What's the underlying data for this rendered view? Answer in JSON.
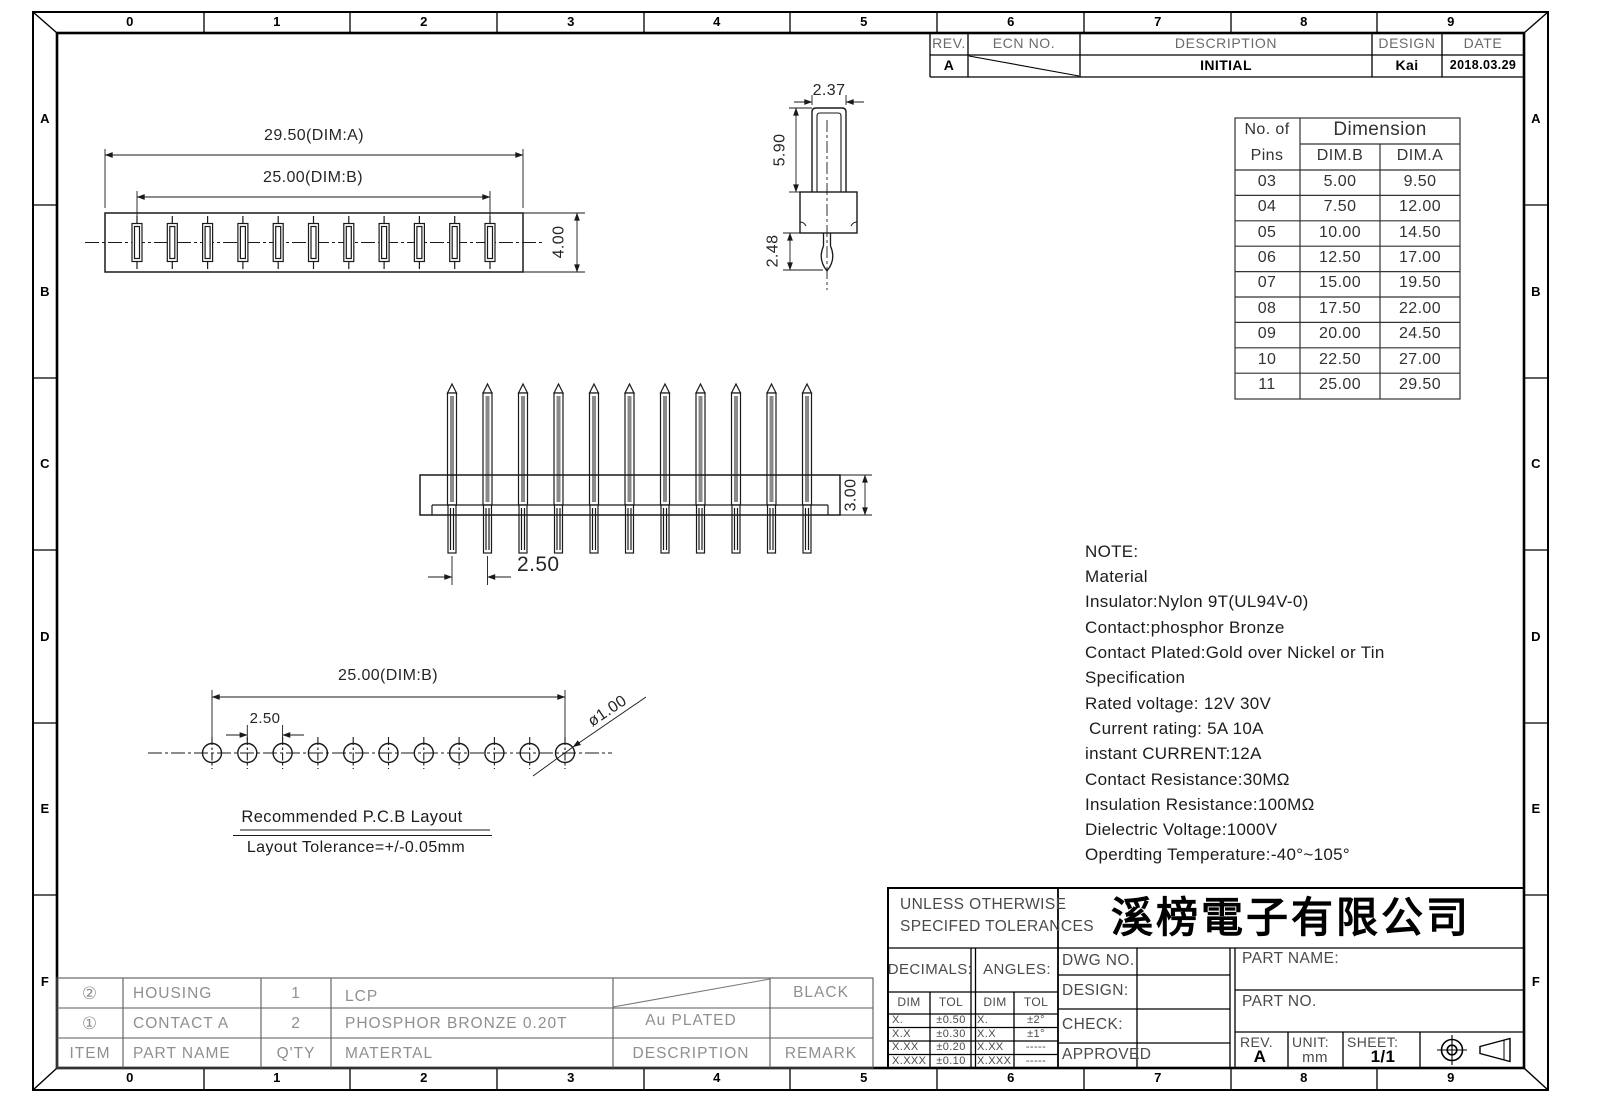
{
  "sheet": {
    "ruler_columns": [
      "0",
      "1",
      "2",
      "3",
      "4",
      "5",
      "6",
      "7",
      "8",
      "9"
    ],
    "ruler_rows": [
      "A",
      "B",
      "C",
      "D",
      "E",
      "F"
    ]
  },
  "rev_table": {
    "headers": {
      "rev": "REV.",
      "ecn": "ECN NO.",
      "description": "DESCRIPTION",
      "design": "DESIGN",
      "date": "DATE"
    },
    "row": {
      "rev": "A",
      "description": "INITIAL",
      "design": "Kai",
      "date": "2018.03.29"
    }
  },
  "dim_table": {
    "col_pins_line1": "No. of",
    "col_pins_line2": "Pins",
    "col_dimension": "Dimension",
    "col_dim_b": "DIM.B",
    "col_dim_a": "DIM.A",
    "rows": [
      [
        "03",
        "5.00",
        "9.50"
      ],
      [
        "04",
        "7.50",
        "12.00"
      ],
      [
        "05",
        "10.00",
        "14.50"
      ],
      [
        "06",
        "12.50",
        "17.00"
      ],
      [
        "07",
        "15.00",
        "19.50"
      ],
      [
        "08",
        "17.50",
        "22.00"
      ],
      [
        "09",
        "20.00",
        "24.50"
      ],
      [
        "10",
        "22.50",
        "27.00"
      ],
      [
        "11",
        "25.00",
        "29.50"
      ]
    ]
  },
  "notes": {
    "lines": [
      "NOTE:",
      "Material",
      "Insulator:Nylon 9T(UL94V-0)",
      "Contact:phosphor Bronze",
      "Contact Plated:Gold over Nickel or Tin",
      "Specification",
      "Rated voltage: 12V 30V",
      "Current rating: 5A 10A",
      "instant CURRENT:12A",
      "Contact Resistance:30MΩ",
      "Insulation Resistance:100MΩ",
      "Dielectric Voltage:1000V",
      "Operdting Temperature:-40°~105°"
    ]
  },
  "dimensions": {
    "top_view_overall": "29.50(DIM:A)",
    "top_view_span": "25.00(DIM:B)",
    "top_view_height": "4.00",
    "pin_width": "2.37",
    "pin_length": "5.90",
    "pin_tail": "2.48",
    "front_pitch": "2.50",
    "front_height": "3.00",
    "pcb_span": "25.00(DIM:B)",
    "pcb_pitch": "2.50",
    "pcb_hole": "ø1.00",
    "pcb_title": "Recommended P.C.B Layout",
    "pcb_tolerance": "Layout Tolerance=+/-0.05mm"
  },
  "parts_table": {
    "headers": {
      "item": "ITEM",
      "part_name": "PART NAME",
      "qty": "Q'TY",
      "material": "MATERTAL",
      "description": "DESCRIPTION",
      "remark": "REMARK"
    },
    "rows": [
      {
        "item": "②",
        "part_name": "HOUSING",
        "qty": "1",
        "material": "LCP",
        "description": "",
        "remark": "BLACK"
      },
      {
        "item": "①",
        "part_name": "CONTACT A",
        "qty": "2",
        "material": "PHOSPHOR BRONZE 0.20T",
        "description": "Au PLATED",
        "remark": ""
      }
    ]
  },
  "title_block": {
    "tolerance_heading_line1": "UNLESS OTHERWISE",
    "tolerance_heading_line2": "SPECIFED TOLERANCES",
    "company": "溪榜電子有限公司",
    "decimals": {
      "label": "DECIMALS:",
      "dim": "DIM",
      "tol": "TOL",
      "rows": [
        [
          "X.",
          "±0.50"
        ],
        [
          "X.X",
          "±0.30"
        ],
        [
          "X.XX",
          "±0.20"
        ],
        [
          "X.XXX",
          "±0.10"
        ]
      ]
    },
    "angles": {
      "label": "ANGLES:",
      "dim": "DIM",
      "tol": "TOL",
      "rows": [
        [
          "X.",
          "±2°"
        ],
        [
          "X.X",
          "±1°"
        ],
        [
          "X.XX",
          "-----"
        ],
        [
          "X.XXX",
          "-----"
        ]
      ]
    },
    "dwg_no_label": "DWG NO.",
    "design_label": "DESIGN:",
    "check_label": "CHECK:",
    "approved_label": "APPROVED",
    "part_name_label": "PART NAME:",
    "part_no_label": "PART NO.",
    "rev_label": "REV.",
    "rev_value": "A",
    "unit_label": "UNIT:",
    "unit_value": "mm",
    "sheet_label": "SHEET:",
    "sheet_value": "1/1"
  }
}
